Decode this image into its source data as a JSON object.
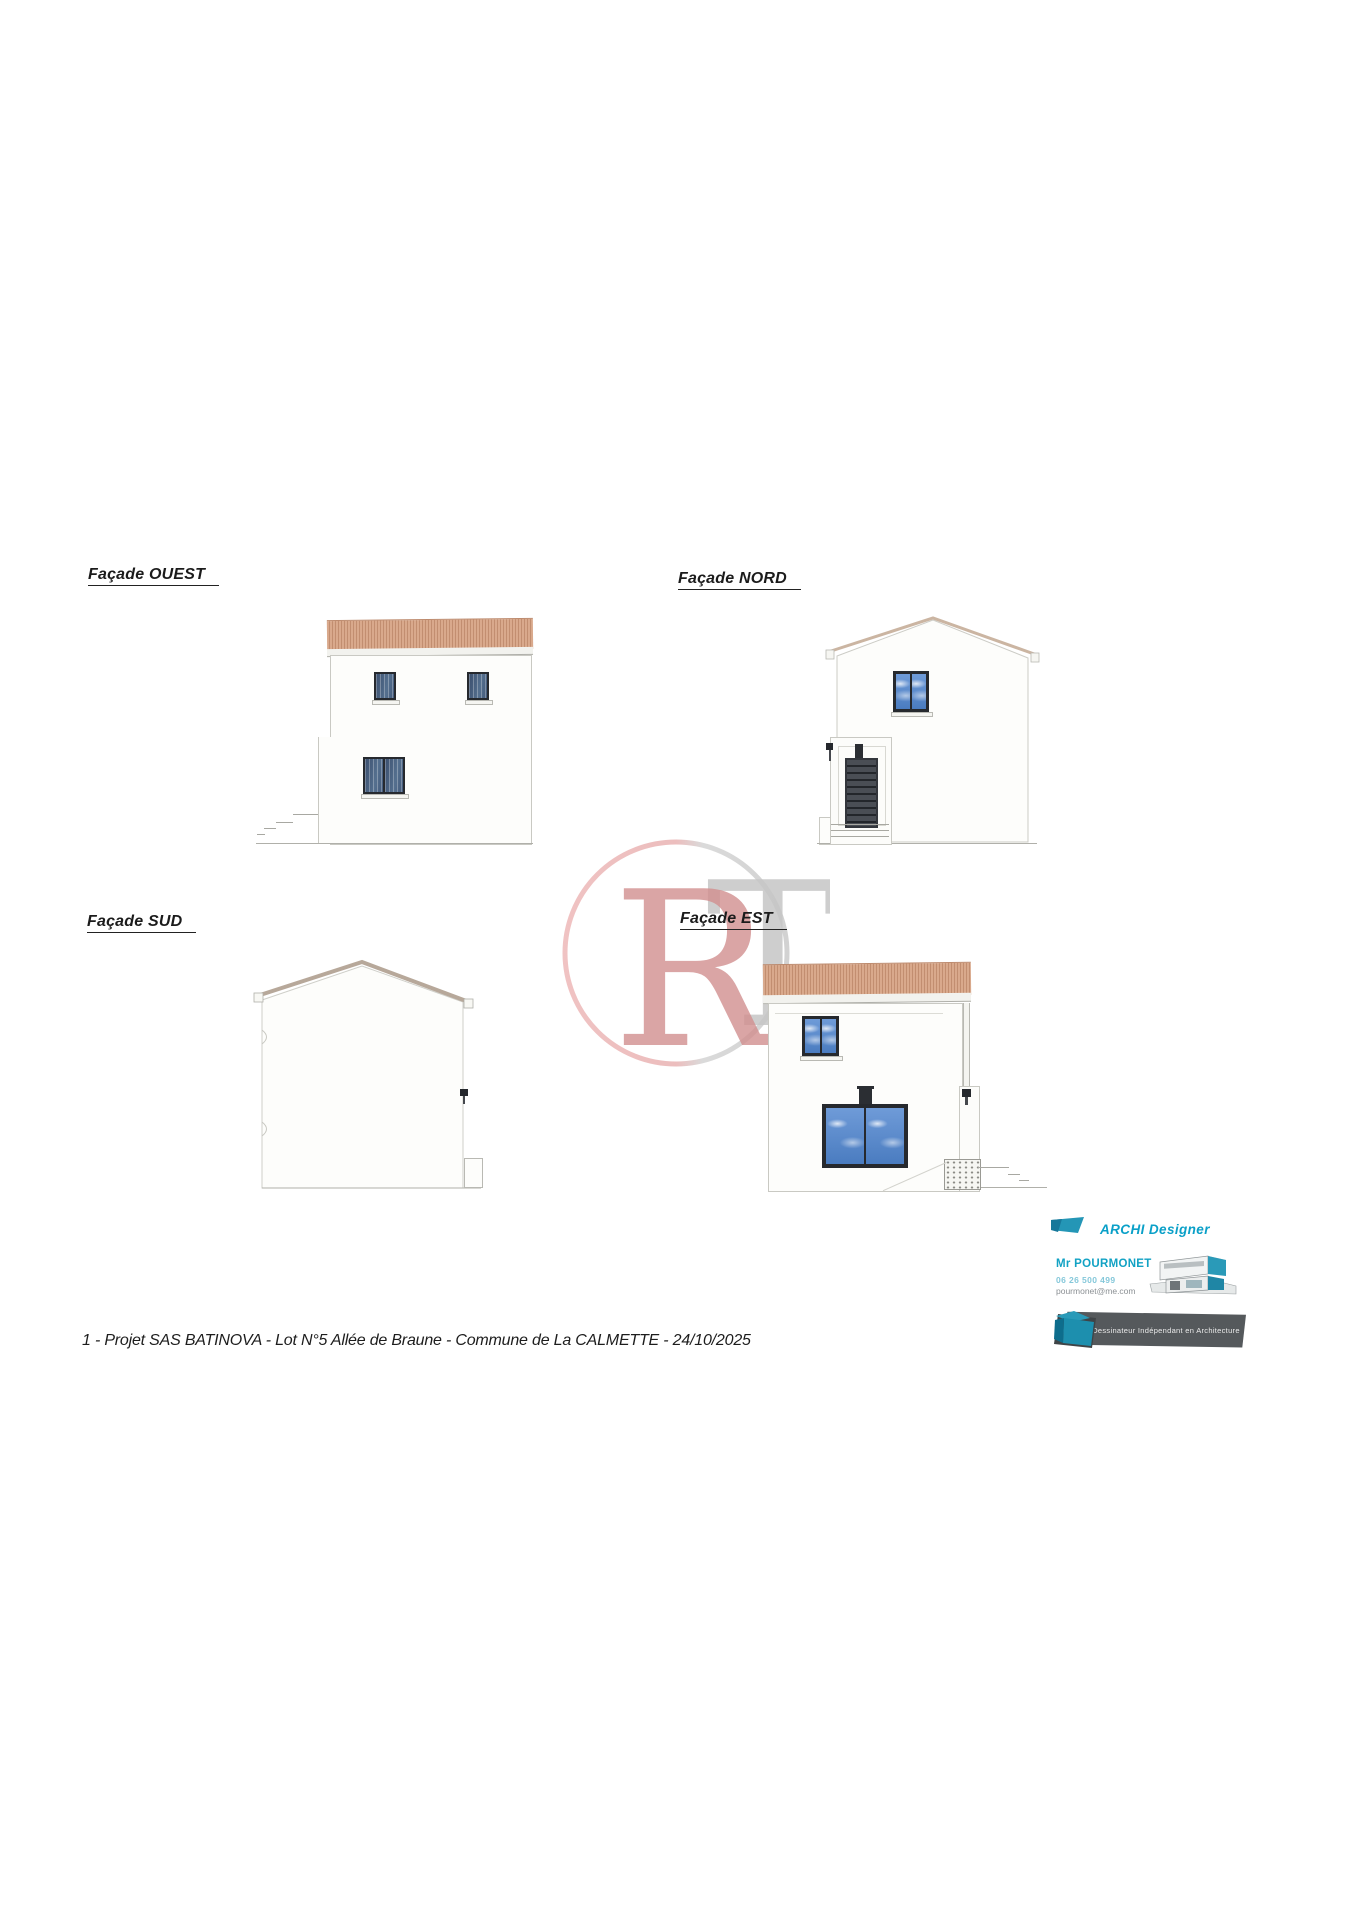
{
  "sheet": {
    "footer": "1 - Projet SAS BATINOVA - Lot N°5 Allée de Braune - Commune de La CALMETTE - 24/10/2025"
  },
  "facade_labels": {
    "ouest": "Façade OUEST",
    "nord": "Façade NORD",
    "sud": "Façade SUD",
    "est": "Façade EST"
  },
  "watermark": {
    "left_letter": "R",
    "right_letter": "T"
  },
  "designer": {
    "brand": "ARCHI Designer",
    "name": "Mr POURMONET",
    "phone": "06 26 500 499",
    "email": "pourmonet@me.com",
    "banner": "Dessinateur Indépendant en Architecture"
  },
  "colors": {
    "roof_tile": "#d9a98c",
    "roof_tile_stripe": "#c28e70",
    "window_frame": "#26292e",
    "glass_dark": "#3f5c80",
    "glass_sky": "#5b8fd0",
    "teal_brand": "#0aa0c8",
    "watermark_pink": "#d28f8f",
    "watermark_grey": "#c6c6c6"
  }
}
